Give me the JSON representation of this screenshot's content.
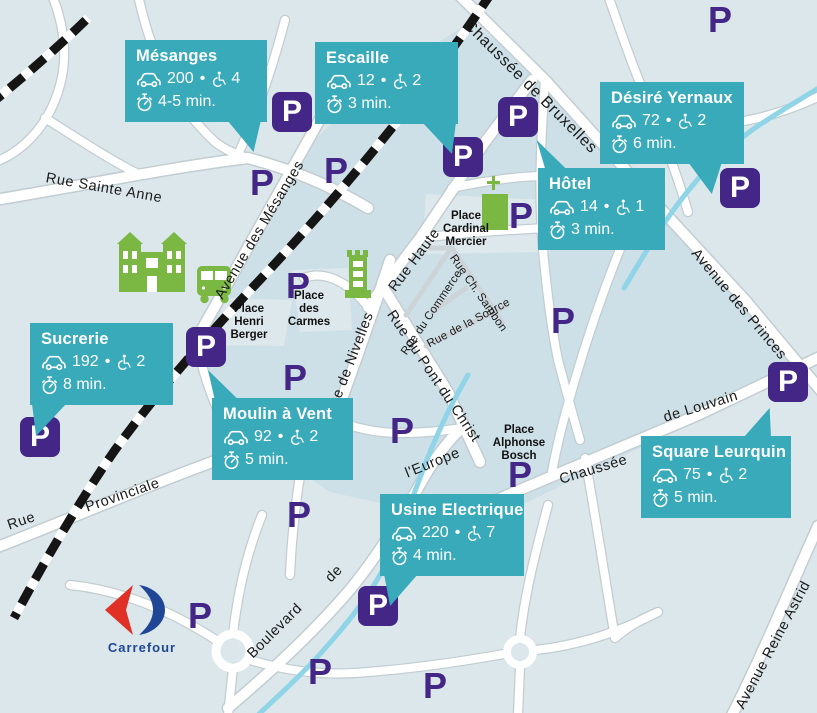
{
  "map": {
    "p_label": "P",
    "colors": {
      "callout_teal": "#38aaba",
      "parking_purple": "#432685",
      "map_green": "#7ab843",
      "stream_blue": "#8fd5e7"
    },
    "street_labels": {
      "bruxelles": "Chaussée de Bruxelles",
      "sainte_anne": "Rue Sainte Anne",
      "mesanges": "Avenue des Mésanges",
      "haute": "Rue Haute",
      "commerce": "Rue du Commerce",
      "sambon": "Rue Ch. Sambon",
      "source": "Rue de la Source",
      "nivelles": "Rue de Nivelles",
      "pont_christ": "Rue du Pont du Christ",
      "princes": "Avenue des Princes",
      "louvain_1": "Chaussée",
      "louvain_2": "de  Louvain",
      "europe_1": "Boulevard",
      "europe_2": "de",
      "europe_3": "l'Europe",
      "provinciale_1": "Rue",
      "provinciale_2": "Provinciale",
      "astrid": "Avenue Reine Astrid"
    },
    "place_labels": {
      "cardinal_mercier": "Place\nCardinal\nMercier",
      "carmes": "Place\ndes\nCarmes",
      "henri_berger": "Place\nHenri\nBerger",
      "alphonse_bosch": "Place\nAlphonse\nBosch"
    },
    "logos": {
      "carrefour": "Carrefour"
    }
  },
  "parkings": [
    {
      "name": "Mésanges",
      "cars": "200",
      "separator": "•",
      "disabled_spots": "4",
      "walk_time": "4-5 min."
    },
    {
      "name": "Escaille",
      "cars": "12",
      "separator": "•",
      "disabled_spots": "2",
      "walk_time": "3 min."
    },
    {
      "name": "Désiré Yernaux",
      "cars": "72",
      "separator": "•",
      "disabled_spots": "2",
      "walk_time": "6 min."
    },
    {
      "name": "Hôtel",
      "cars": "14",
      "separator": "•",
      "disabled_spots": "1",
      "walk_time": "3 min."
    },
    {
      "name": "Sucrerie",
      "cars": "192",
      "separator": "•",
      "disabled_spots": "2",
      "walk_time": "8 min."
    },
    {
      "name": "Moulin à Vent",
      "cars": "92",
      "separator": "•",
      "disabled_spots": "2",
      "walk_time": "5 min."
    },
    {
      "name": "Usine Electrique",
      "cars": "220",
      "separator": "•",
      "disabled_spots": "7",
      "walk_time": "4 min."
    },
    {
      "name": "Square Leurquin",
      "cars": "75",
      "separator": "•",
      "disabled_spots": "2",
      "walk_time": "5 min."
    }
  ]
}
